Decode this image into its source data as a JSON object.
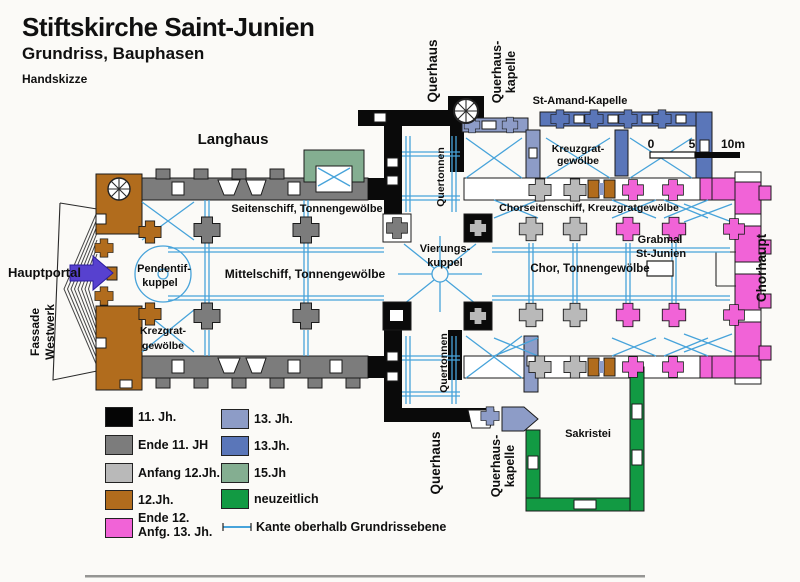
{
  "header": {
    "title": "Stiftskirche Saint-Junien",
    "subtitle": "Grundriss, Bauphasen",
    "note": "Handskizze"
  },
  "scalebar": {
    "zero": "0",
    "five": "5",
    "ten": "10m"
  },
  "plan_labels": {
    "langhaus": "Langhaus",
    "querhaus_top": "Querhaus",
    "querhaus_kapelle_top_1": "Querhaus-",
    "querhaus_kapelle_top_2": "kapelle",
    "st_amand": "St-Amand-Kapelle",
    "kreuzgrat_top_1": "Kreuzgrat-",
    "kreuzgrat_top_2": "gewölbe",
    "seitenschiff": "Seitenschiff, Tonnengewölbe",
    "chorseitenschiff": "Chorseitenschiff, Kreuzgratgewölbe",
    "quertonnen_nord": "Quertonnen",
    "quertonnen_sued": "Quertonnen",
    "vierung_1": "Vierungs-",
    "vierung_2": "kuppel",
    "pendentif_1": "Pendentif-",
    "pendentif_2": "kuppel",
    "mittelschiff": "Mittelschiff, Tonnengewölbe",
    "chor": "Chor, Tonnengewölbe",
    "grabmal_1": "Grabmal",
    "grabmal_2": "St-Junien",
    "chorhaupt": "Chorhaupt",
    "hauptportal": "Hauptportal",
    "fassade_1": "Fassade",
    "fassade_2": "Westwerk",
    "krezgrat_1": "Krezgrat-",
    "krezgrat_2": "gewölbe",
    "querhaus_bottom": "Querhaus",
    "querhaus_kapelle_bottom_1": "Querhaus-",
    "querhaus_kapelle_bottom_2": "kapelle",
    "sakristei": "Sakristei"
  },
  "legend": {
    "col1": [
      {
        "label": "11. Jh.",
        "color": "#050505"
      },
      {
        "label": "Ende 11. JH",
        "color": "#7c7c7c"
      },
      {
        "label": "Anfang 12.Jh.",
        "color": "#b9b9b9"
      },
      {
        "label": "12.Jh.",
        "color": "#b16c1d"
      },
      {
        "label": "Ende 12.",
        "label2": "Anfg. 13. Jh.",
        "color": "#f163d7"
      }
    ],
    "col2": [
      {
        "label": "13. Jh.",
        "color": "#8d9cc7"
      },
      {
        "label": "13.Jh.",
        "color": "#5a76b9"
      },
      {
        "label": "15.Jh",
        "color": "#84ae91"
      },
      {
        "label": "neuzeitlich",
        "color": "#129a43"
      }
    ],
    "edge_note": "Kante oberhalb Grundrissebene"
  },
  "colors": {
    "vault_line": "#47a3da",
    "portal_arrow": "#5741cf",
    "phase_11jh": "#050505",
    "phase_ende11": "#7c7c7c",
    "phase_anfang12": "#b9b9b9",
    "phase_12jh": "#b16c1d",
    "phase_ende12_anf13": "#f163d7",
    "phase_13jh_hell": "#8d9cc7",
    "phase_13jh": "#5a76b9",
    "phase_15jh": "#84ae91",
    "phase_neuzeitlich": "#129a43"
  }
}
